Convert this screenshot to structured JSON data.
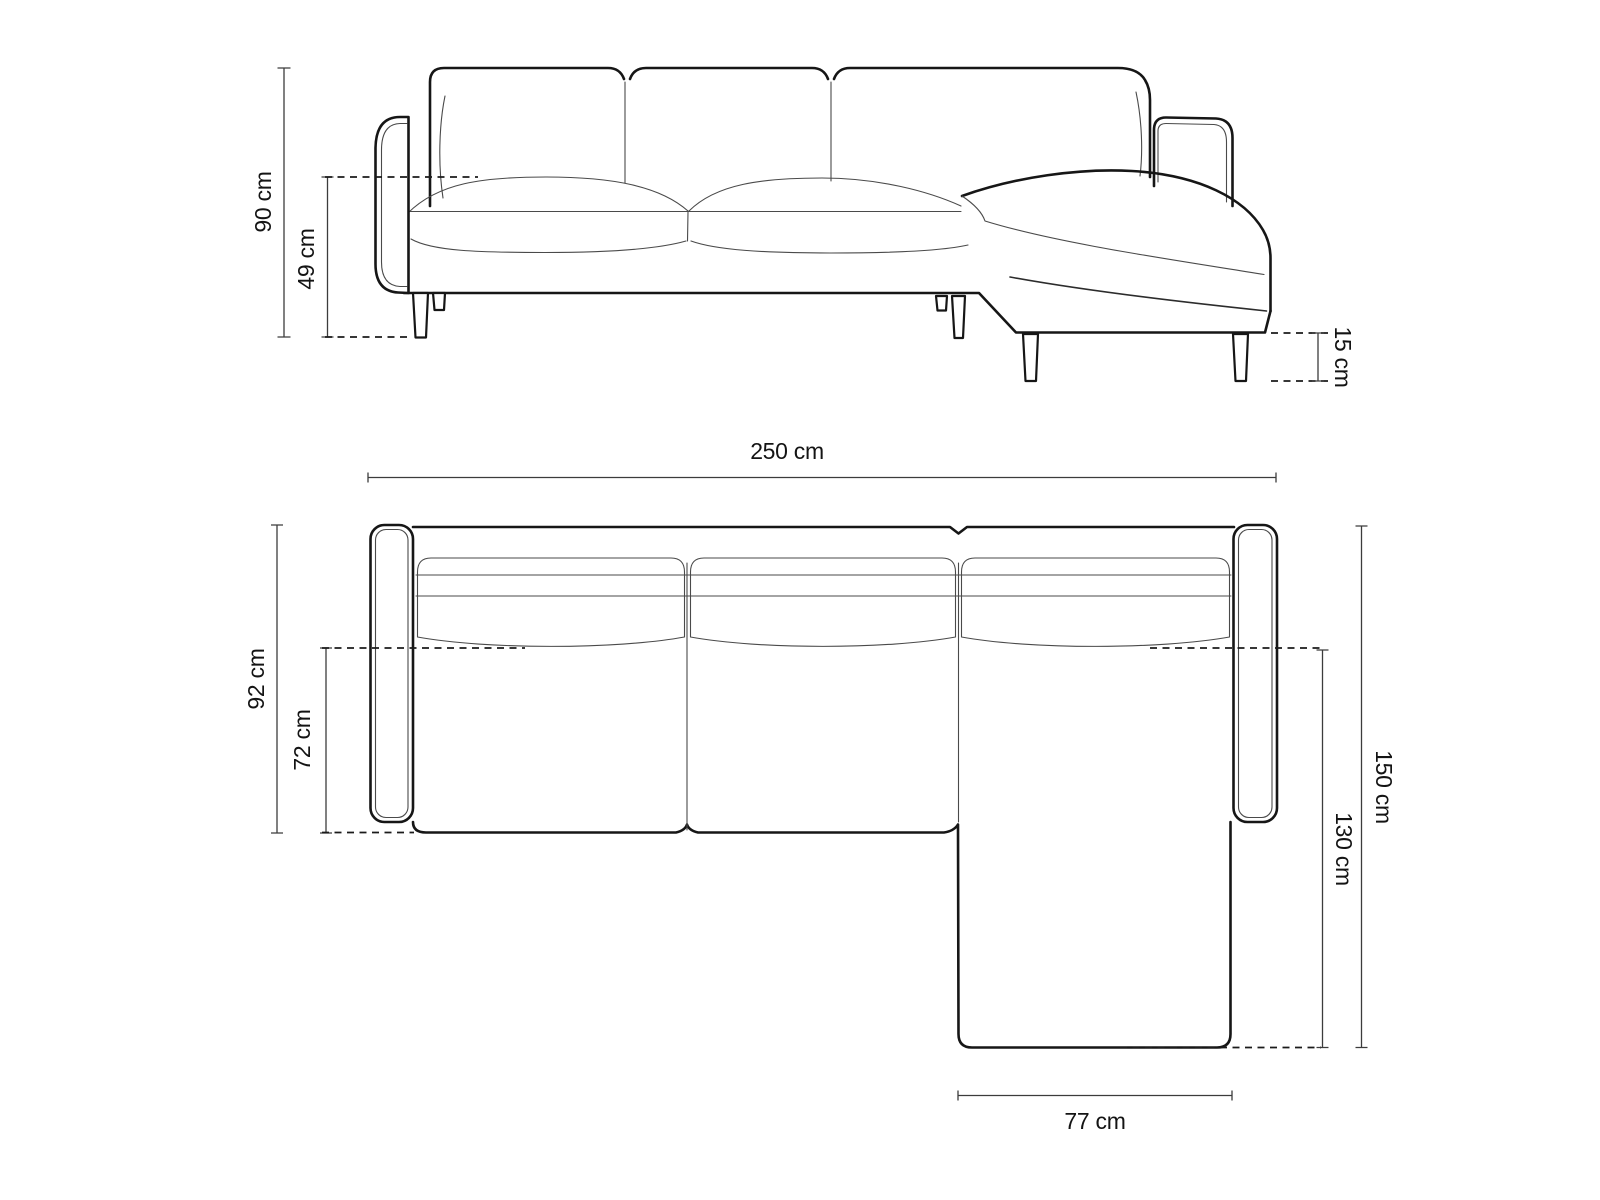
{
  "diagram": {
    "subject": "corner-sofa-with-chaise",
    "unit": "cm",
    "views": {
      "front": "front-elevation",
      "top": "plan-view"
    }
  },
  "dimensions": {
    "front": [
      {
        "id": "total-height",
        "label": "90 cm",
        "value": 90
      },
      {
        "id": "seat-height",
        "label": "49 cm",
        "value": 49
      },
      {
        "id": "leg-height",
        "label": "15 cm",
        "value": 15
      }
    ],
    "top": [
      {
        "id": "total-width",
        "label": "250 cm",
        "value": 250
      },
      {
        "id": "total-depth",
        "label": "92 cm",
        "value": 92
      },
      {
        "id": "seat-depth",
        "label": "72 cm",
        "value": 72
      },
      {
        "id": "chaise-outer-length",
        "label": "150 cm",
        "value": 150
      },
      {
        "id": "chaise-length",
        "label": "130 cm",
        "value": 130
      },
      {
        "id": "chaise-width",
        "label": "77 cm",
        "value": 77
      }
    ]
  }
}
